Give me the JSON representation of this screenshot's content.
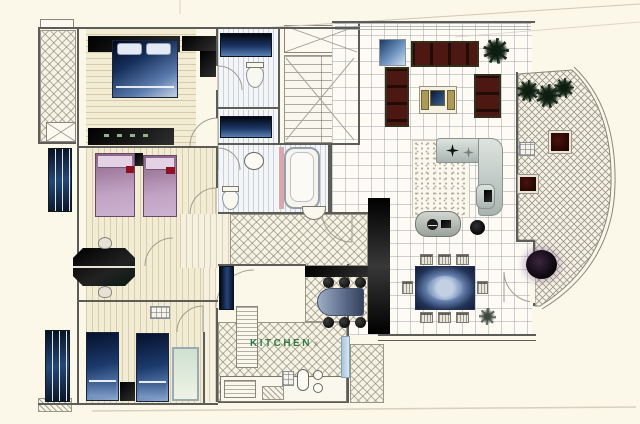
{
  "document": {
    "type": "scanned apartment floor plan"
  },
  "labels": {
    "kitchen": "KITCHEN",
    "kitchen_mark": "x"
  },
  "palette": {
    "paper": "#fbf7e9",
    "wall": "#5c5c58",
    "wood": "#f3ecd4",
    "crimson": "#8e1022",
    "khaki": "#ab9a58",
    "green_label": "#2e7c46",
    "hatch_line": "#98948a",
    "tile_line": "#bcc0c8",
    "bed_blue_dark": "#05102c",
    "bed_blue_light": "#b7c6dd",
    "bed_plum": "#c1a2c4",
    "sofa_maroon": "#4e1812",
    "counter_navy": "#1c3868",
    "rug_blue": "#233357",
    "gray_sofa": "#a9b4b0",
    "red_table": "#4a130c",
    "plant_green": "#0e1d10",
    "door_blue": "#a8c4dc",
    "scan_crease": "#cfc8b4"
  }
}
